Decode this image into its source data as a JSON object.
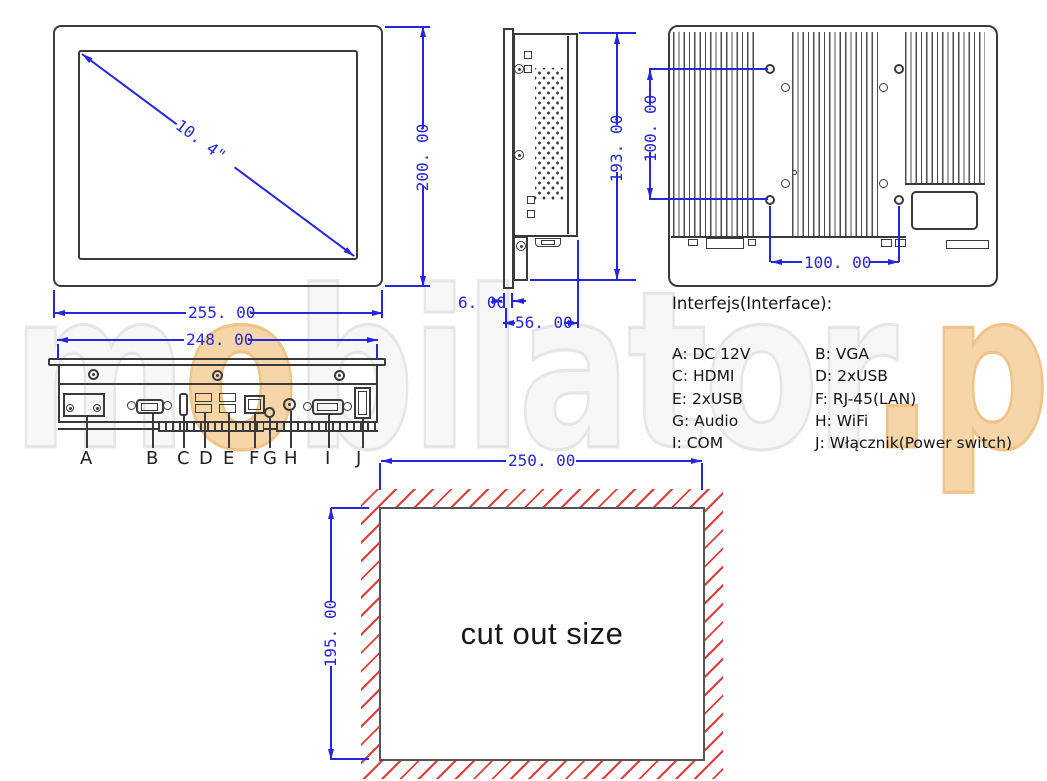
{
  "title": "Panel PC technical drawing",
  "colors": {
    "dimension_blue": "#2626dd",
    "drawing_dark": "#3a3a3a",
    "hatch_red": "#e23b3b",
    "watermark_gray": "#e6e6e6",
    "watermark_orange": "#f6d5a8"
  },
  "watermark": {
    "m": "m",
    "o": "o",
    "rest": "bilator",
    "pl": ".pl"
  },
  "front": {
    "diagonal": "10. 4\"",
    "height": "200. 00",
    "width": "255. 00"
  },
  "bottomv": {
    "width": "248. 00",
    "labels": [
      "A",
      "B",
      "C",
      "D",
      "E",
      "F",
      "G",
      "H",
      "I",
      "J"
    ]
  },
  "side": {
    "height": "193. 00",
    "depth": "56. 00",
    "bezel": "6. 00"
  },
  "back": {
    "vesa_v": "100. 00",
    "vesa_h": "100. 00"
  },
  "cutout": {
    "width": "250. 00",
    "height": "195. 00",
    "label": "cut out size"
  },
  "legend": {
    "title": "Interfejs(Interface):",
    "left": [
      "A: DC 12V",
      "C: HDMI",
      "E: 2xUSB",
      "G: Audio",
      "I: COM"
    ],
    "right": [
      "B: VGA",
      "D: 2xUSB",
      "F: RJ-45(LAN)",
      "H: WiFi",
      "J: Włącznik(Power switch)"
    ]
  }
}
